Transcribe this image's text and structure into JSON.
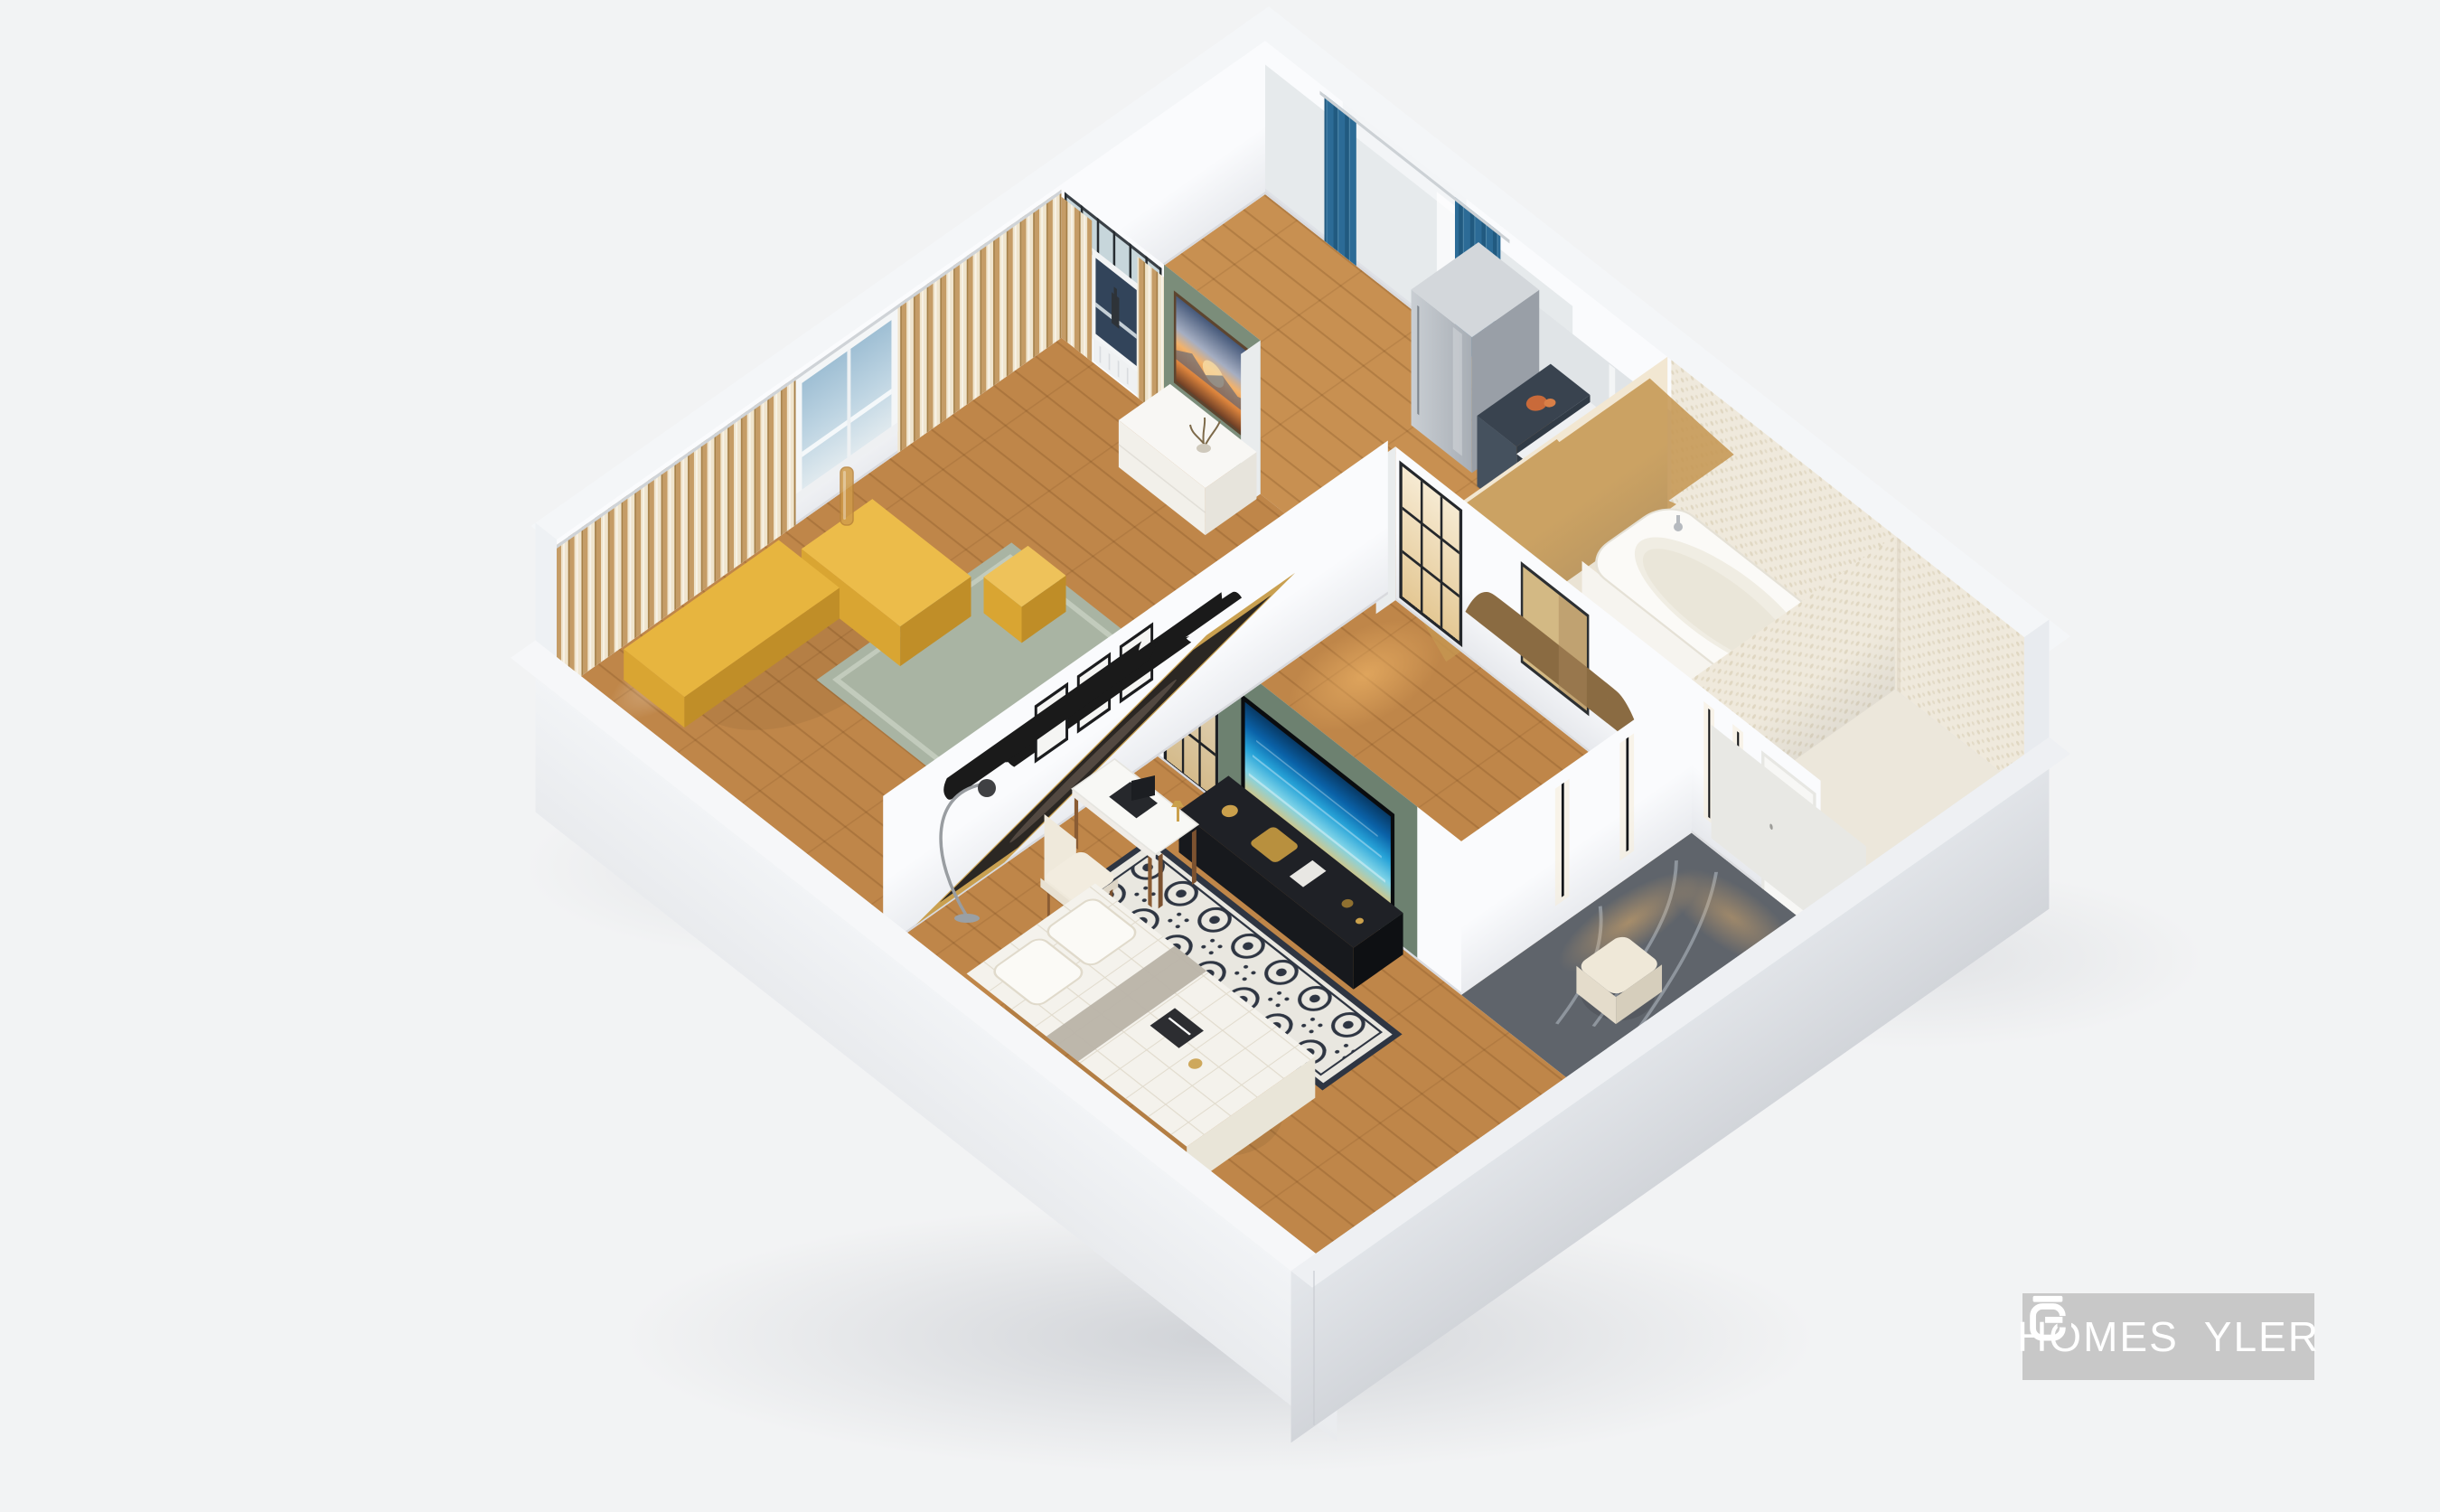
{
  "watermark": {
    "brand": "HOMESTYLER",
    "text_left": "HOMES",
    "t_bar": "|",
    "text_right": "YLER",
    "icon": "homestyler-logo-icon"
  },
  "scene": {
    "type": "3d_floorplan_render",
    "camera": "isometric_birdseye",
    "description": "Roofless dollhouse 3D rendering of a one-bedroom apartment on a light gray backdrop",
    "rooms": [
      {
        "id": "bedroom_lounge",
        "label": "Bedroom lounge",
        "position": "upper-left",
        "floor": "oak plank",
        "accent_wall_color": "#7b8d7a",
        "features": [
          "clerestory transom glass band",
          "beige striped drapes on two walls",
          "sea-view window with bottle on sill",
          "side window with sky view",
          "sunset seascape canvas on green wall"
        ],
        "furniture": [
          "white low sideboard",
          "dried-branch vase",
          "sage green shag rug",
          "mustard-gold daybed set",
          "gold cube side table",
          "amber glass floor vase"
        ]
      },
      {
        "id": "kitchen_nook",
        "label": "Kitchen nook and balcony door",
        "position": "top",
        "floor": "oak plank",
        "features": [
          "white French balcony door",
          "teal-blue drapes",
          "white sheer curtain"
        ],
        "furniture": [
          "brushed-steel tall cabinet",
          "white compact counter",
          "navy counter shelf",
          "coral sculpture"
        ]
      },
      {
        "id": "bathroom",
        "label": "Bathroom",
        "position": "upper-right",
        "floor": "cream stone",
        "features": [
          "gold-veined marble feature wall",
          "pebble-textured cream walls"
        ],
        "furniture": [
          "freestanding white bathtub",
          "chrome faucet"
        ]
      },
      {
        "id": "wc",
        "label": "Water closet",
        "position": "right corner",
        "floor": "cream stone",
        "features": [
          "pebble-textured walls",
          "white door"
        ]
      },
      {
        "id": "hallway",
        "label": "Hallway",
        "position": "center",
        "floor": "oak plank",
        "features": [
          "black-framed interior window with warm backlight",
          "black-framed glass door",
          "rattan fan wall art"
        ]
      },
      {
        "id": "living_media_room",
        "label": "Living media room",
        "position": "lower-center",
        "floor": "oak plank",
        "accent_wall_color": "#6d8170",
        "features": [
          "green media wall",
          "wall TV showing ocean scene",
          "three monochrome gallery prints",
          "gold-framed dark photograph"
        ],
        "furniture": [
          "black low media console with brass objects",
          "ivory-navy ornate runner rug",
          "white tufted daybed with pillows",
          "white writing desk",
          "black laptop",
          "cream upholstered chair",
          "arc floor lamp"
        ]
      },
      {
        "id": "entry_foyer",
        "label": "Entry foyer",
        "position": "right",
        "floor": "charcoal marble",
        "features": [
          "recessed vertical LED wall lights",
          "warm floor glow"
        ],
        "furniture": [
          "cream pouf"
        ]
      }
    ]
  },
  "palette": {
    "background": "#f2f3f4",
    "wall_face": "#fafbfd",
    "wall_top": "#f4f6f8",
    "exterior_sw": "#eef1f4",
    "exterior_se": "#d9dce1",
    "accent_green": "#7b8d7a",
    "accent_green_dark": "#6d8170",
    "wood": "#bf8649",
    "wood_light": "#c89051",
    "tile_cream": "#eae3d4",
    "marble_cream": "#f2e7d2",
    "marble_vein": "#c49550",
    "pebble": "#efe9dc",
    "pebble_dot": "#e0d7c2",
    "entry_marble": "#5f646b",
    "entry_vein": "#9aa1aa",
    "curtain_base": "#efe4cd",
    "curtain_stripe": "#c59c66",
    "curtain_stripe_dark": "#a57f47",
    "curtain_blue": "#2c6b96",
    "curtain_blue_dark": "#215a80",
    "ocean_deep": "#083a66",
    "ocean_mid": "#27a3d8",
    "sand": "#d9c47e",
    "sunset_orange": "#e9964f",
    "rug_sage": "#a9b4a3",
    "rug_ivory": "#e9e7e0",
    "rug_navy": "#2e3542",
    "gold": "#caa04c",
    "gold_bright": "#e7b53f",
    "watermark_bg": "#c8c8c8",
    "watermark_text": "#ffffff"
  }
}
